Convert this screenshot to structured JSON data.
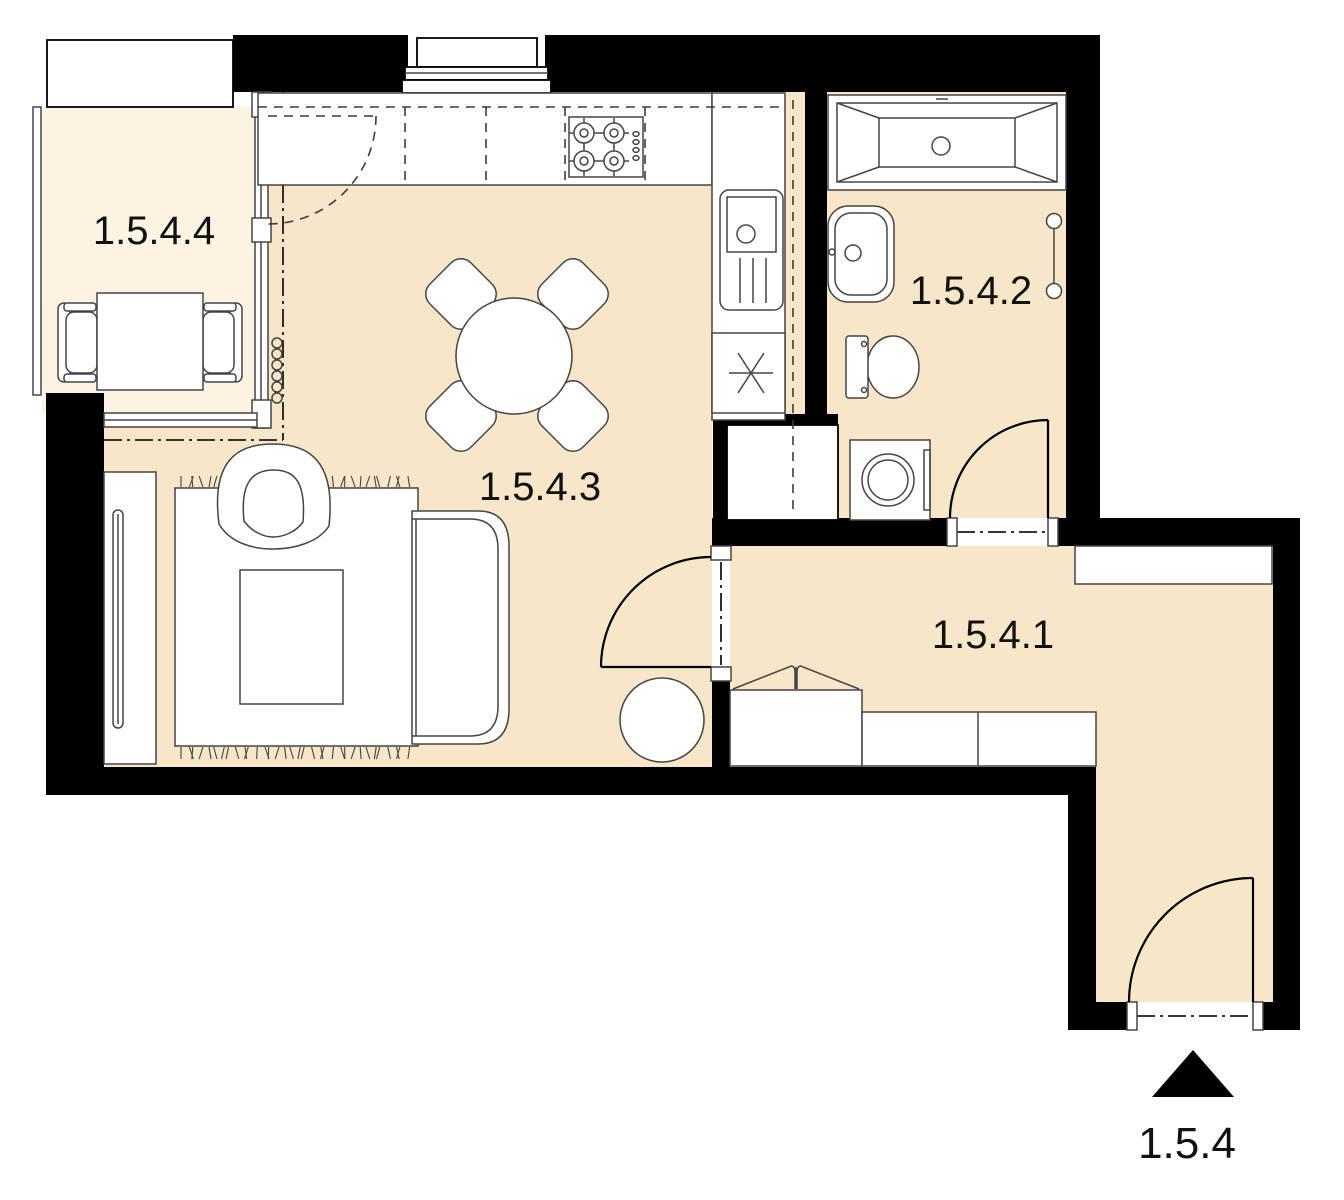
{
  "plan": {
    "unit_label": "1.5.4",
    "rooms": {
      "hallway": {
        "label": "1.5.4.1"
      },
      "bathroom": {
        "label": "1.5.4.2"
      },
      "living": {
        "label": "1.5.4.3"
      },
      "balcony": {
        "label": "1.5.4.4"
      }
    }
  },
  "icons": {
    "entrance_arrow": "▲"
  },
  "colors": {
    "wall": "#000000",
    "floor": "#f7e6c8",
    "balcony_floor": "#fcf3e2",
    "line": "#444444",
    "door": "#000000",
    "label": "#111111"
  }
}
